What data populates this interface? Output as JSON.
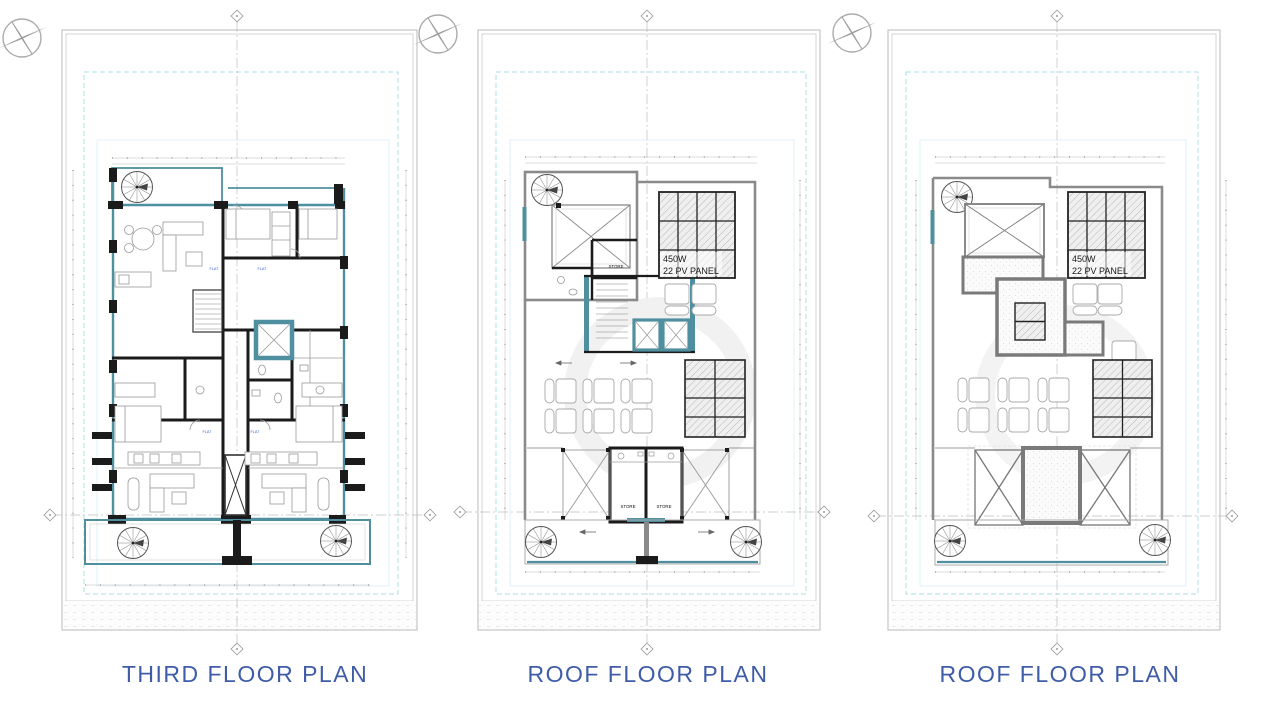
{
  "drawing": {
    "kind": "architectural floor plan sheets",
    "sheet_count": 3
  },
  "sheets": [
    {
      "title": "THIRD FLOOR PLAN"
    },
    {
      "title": "ROOF FLOOR PLAN",
      "pv": {
        "line1": "450W",
        "line2": "22 PV PANEL"
      },
      "stores": [
        "STORE",
        "STORE",
        "STORE"
      ]
    },
    {
      "title": "ROOF FLOOR PLAN",
      "pv": {
        "line1": "450W",
        "line2": "22 PV PANEL"
      }
    }
  ],
  "plan_labels": {
    "flat": "FLAT"
  },
  "colors": {
    "title_blue": "#3f5ca8",
    "wall_black": "#1b1b1b",
    "teal_wall": "#4f8fa0",
    "parapet_gray": "#8a8a8a",
    "site_boundary_cyan": "#a8dce4",
    "flat_label_blue": "#3a5fd0"
  }
}
